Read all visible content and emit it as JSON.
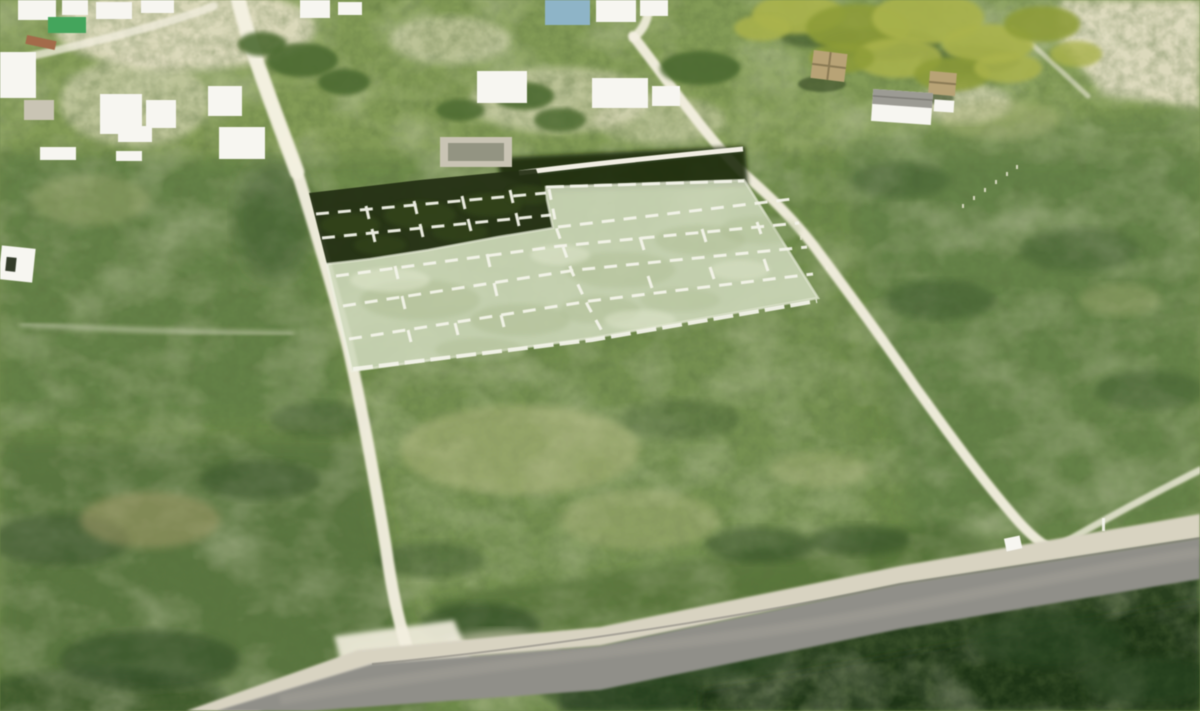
{
  "meta": {
    "type": "aerial-drone-photograph",
    "subject": "vacant coastal land with highlighted surveyed lots for sale"
  },
  "scene": {
    "colors": {
      "base_vegetation": "#6f8a4c",
      "top_field": "#94a963",
      "scrub_dark": "#2c4422",
      "forest_dark": "#24381d",
      "forest_deep": "#1c3118",
      "dry_grass": "#b9bd86",
      "dry_brown": "#a89f6e",
      "sand": "#e9e2cb",
      "dirt_road": "#f3efe0",
      "road_shoulder": "#d8d3c2",
      "asphalt": "#908f89",
      "asphalt_worn": "#a5a299",
      "overlay_light": "#cfd9bc",
      "overlay_dark": "#232f14",
      "lot_line_white": "#f4f4ea",
      "building_white": "#f7f6f1",
      "roof_gray": "#9c9b94",
      "concrete_gray": "#c9c4b4",
      "blue_building": "#8fb4c6",
      "green_structure": "#46a45d",
      "boat_red": "#a26b4b",
      "thatch_tan": "#b7a377",
      "palm_canopy": "#aab34f",
      "palm_canopy_dark": "#8d9c3b",
      "wall_white": "#f2efe4",
      "shadow_band": "#1b2a11"
    },
    "overlay": {
      "description": "two adjoining highlighted parcels subdivided into small lots by white dashed survey lines",
      "sections": [
        {
          "name": "shaded-section",
          "appearance": "dark tree-shadowed scrub under highlight",
          "dash_rows": 2
        },
        {
          "name": "sunlit-section",
          "appearance": "pale translucent green highlight",
          "dash_rows": 4
        }
      ]
    },
    "roads": [
      {
        "name": "west-dirt-road",
        "surface": "white sand"
      },
      {
        "name": "east-dirt-road",
        "surface": "white sand"
      },
      {
        "name": "north-access-road",
        "surface": "white sand"
      },
      {
        "name": "paved-highway",
        "surface": "gray asphalt with gravel shoulder"
      },
      {
        "name": "junction-spur",
        "surface": "white sand"
      }
    ],
    "landmarks": [
      {
        "name": "village-houses-top-left"
      },
      {
        "name": "blue-building-top-center"
      },
      {
        "name": "boundary-wall-behind-plots"
      },
      {
        "name": "palm-grove-top-right"
      },
      {
        "name": "thatched-palapa-huts"
      },
      {
        "name": "gray-roof-house-right"
      },
      {
        "name": "white-road-sign-at-junction"
      },
      {
        "name": "dense-forest-bottom-right"
      }
    ]
  }
}
